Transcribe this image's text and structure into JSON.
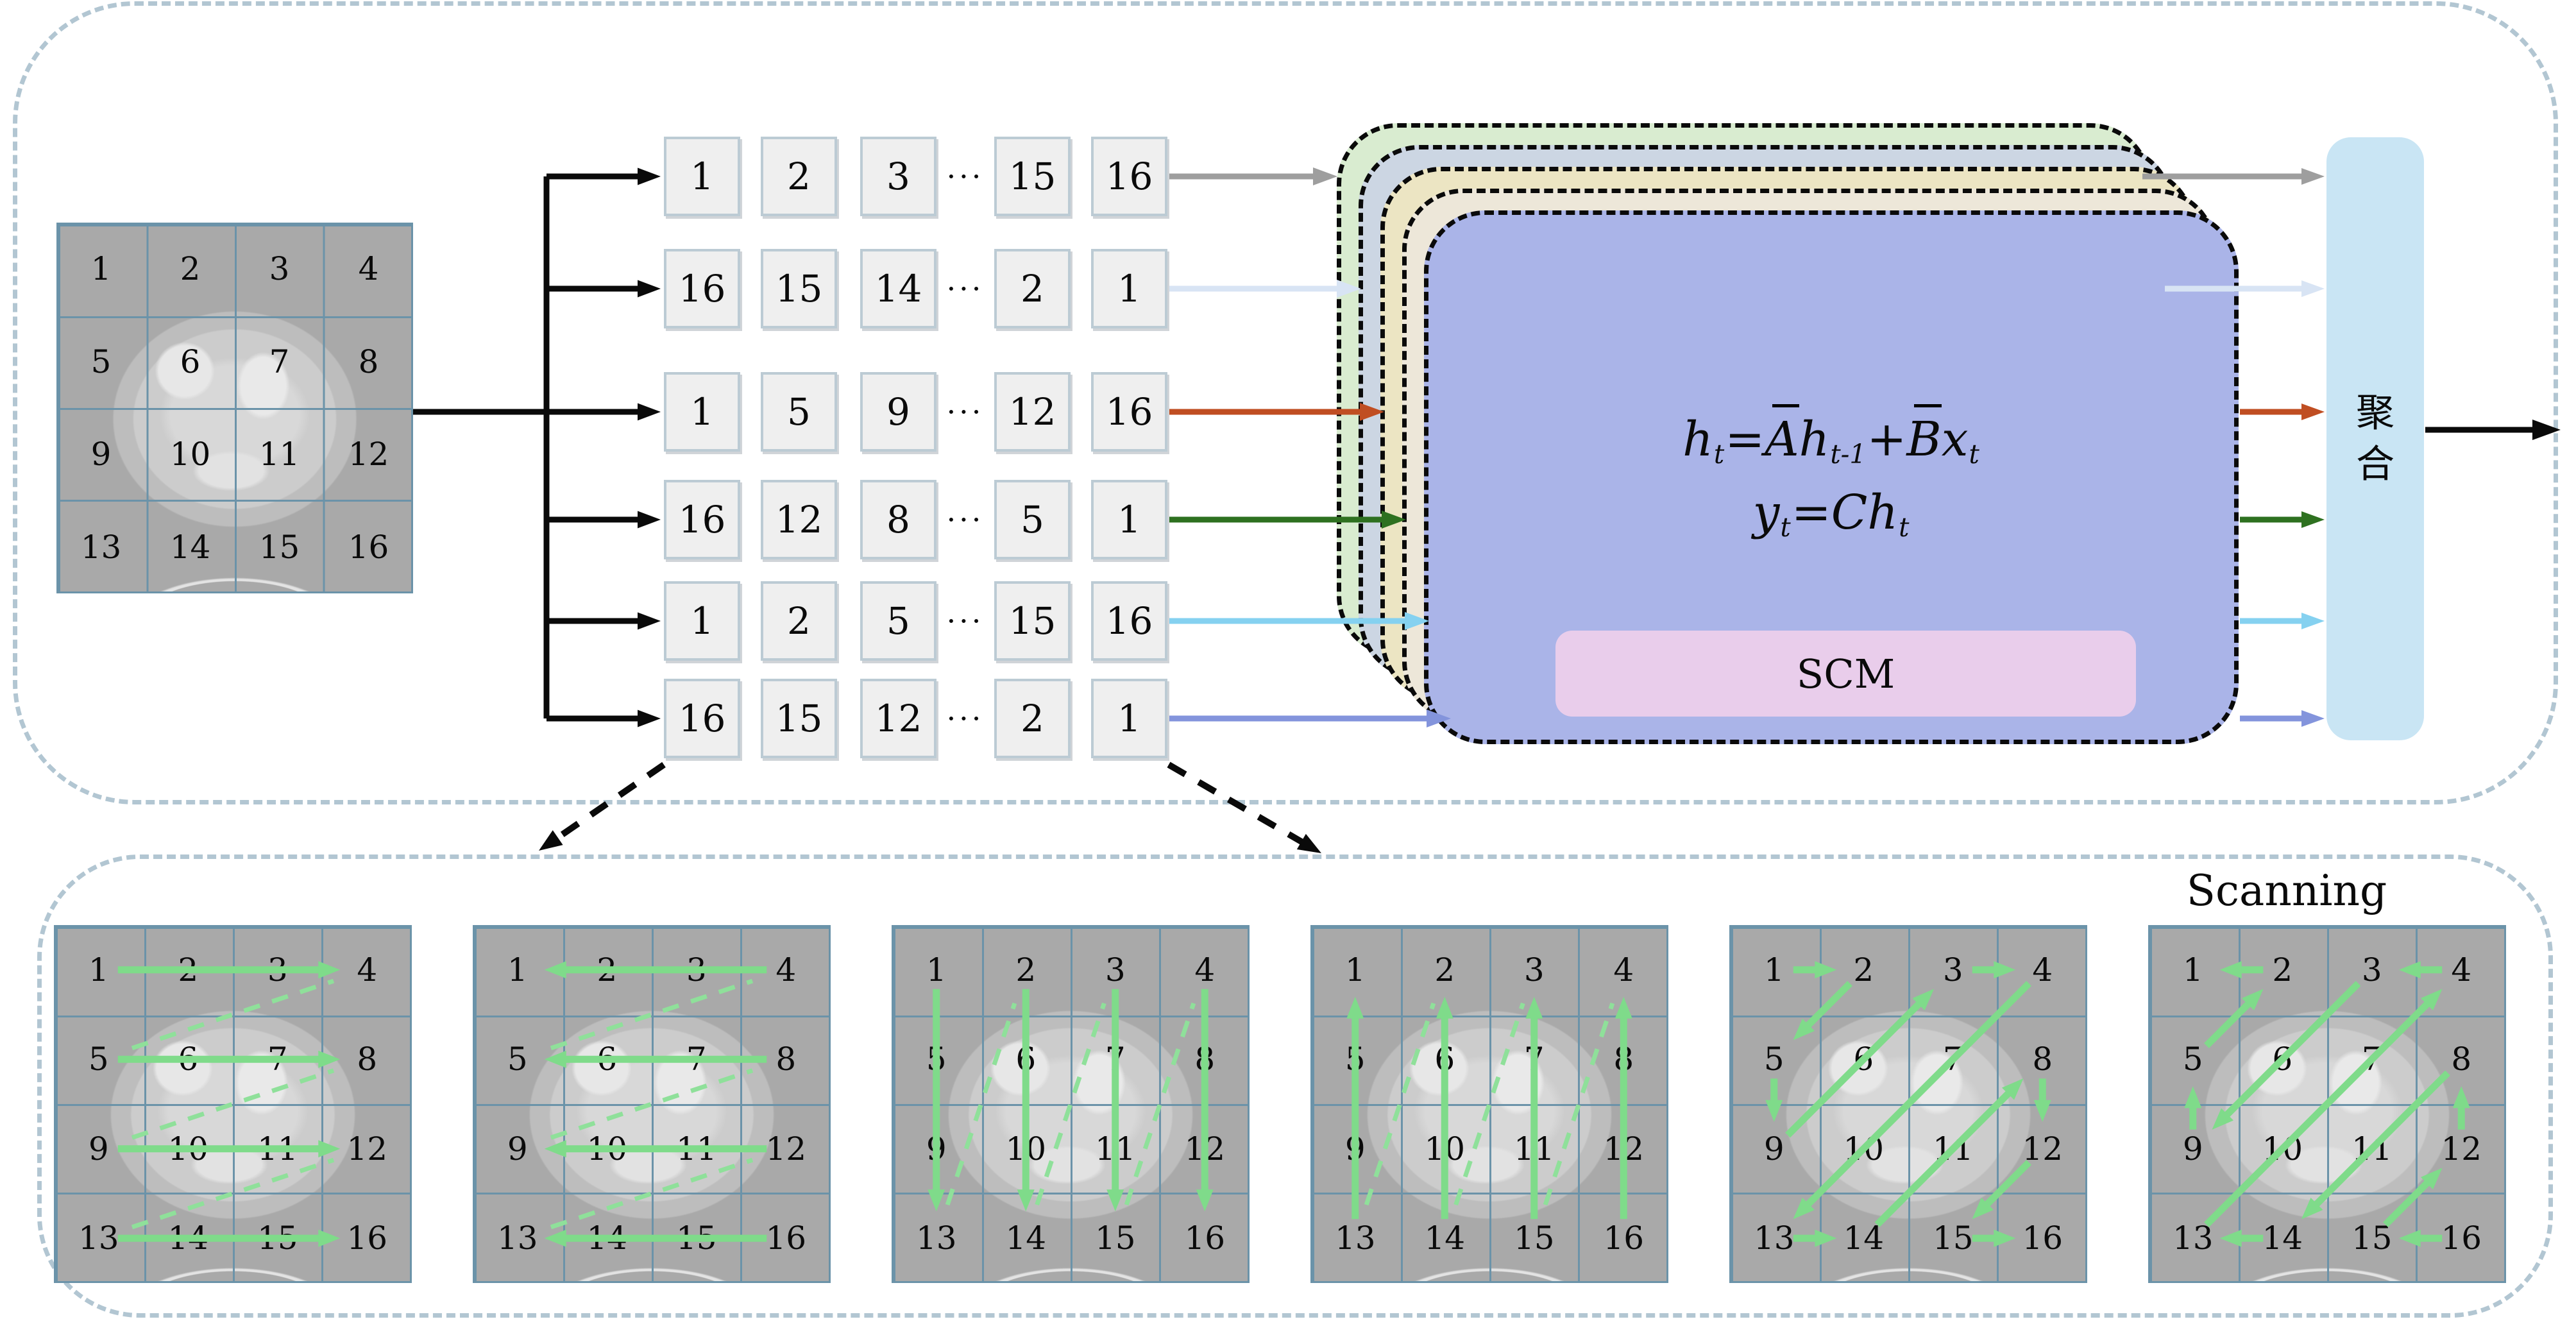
{
  "diagram": {
    "grid_labels": [
      "1",
      "2",
      "3",
      "4",
      "5",
      "6",
      "7",
      "8",
      "9",
      "10",
      "11",
      "12",
      "13",
      "14",
      "15",
      "16"
    ],
    "sequence_rows": [
      {
        "cells": [
          "1",
          "2",
          "3",
          "···",
          "15",
          "16"
        ],
        "color": "#9e9e9e"
      },
      {
        "cells": [
          "16",
          "15",
          "14",
          "···",
          "2",
          "1"
        ],
        "color": "#d8e4f4"
      },
      {
        "cells": [
          "1",
          "5",
          "9",
          "···",
          "12",
          "16"
        ],
        "color": "#c04e22"
      },
      {
        "cells": [
          "16",
          "12",
          "8",
          "···",
          "5",
          "1"
        ],
        "color": "#2e7120"
      },
      {
        "cells": [
          "1",
          "2",
          "5",
          "···",
          "15",
          "16"
        ],
        "color": "#85d1f0"
      },
      {
        "cells": [
          "16",
          "15",
          "12",
          "···",
          "2",
          "1"
        ],
        "color": "#8394dc"
      }
    ],
    "stack_layers": [
      "#d9ecd0",
      "#ccd6e3",
      "#ece5c3",
      "#ede7d9",
      "#aab4e8"
    ],
    "stack_border": "#0a0a0a",
    "equations": {
      "line1": [
        [
          "h",
          "i"
        ],
        [
          "t",
          "sub"
        ],
        [
          "=",
          "p"
        ],
        [
          "A",
          "ibar"
        ],
        [
          "h",
          "i"
        ],
        [
          "t-1",
          "sub"
        ],
        [
          "+",
          "p"
        ],
        [
          "B",
          "ibar"
        ],
        [
          "x",
          "i"
        ],
        [
          "t",
          "sub"
        ]
      ],
      "line2": [
        [
          "y",
          "i"
        ],
        [
          "t",
          "sub"
        ],
        [
          "=",
          "p"
        ],
        [
          "C",
          "i"
        ],
        [
          "h",
          "i"
        ],
        [
          "t",
          "sub"
        ]
      ]
    },
    "scm_label": "SCM",
    "aggregate_label": "聚合",
    "scanning_label": "Scanning",
    "arrow_green": "#7fdb8a",
    "arrow_green_dash": "#8fe09a",
    "panel_border_color": "#b2c6d2",
    "grid_line_color": "#6b93a9",
    "scan_patterns": [
      {
        "solid": [
          [
            [
              0,
              0
            ],
            [
              3,
              0
            ]
          ],
          [
            [
              0,
              1
            ],
            [
              3,
              1
            ]
          ],
          [
            [
              0,
              2
            ],
            [
              3,
              2
            ]
          ],
          [
            [
              0,
              3
            ],
            [
              3,
              3
            ]
          ]
        ],
        "dashed": [
          [
            [
              0,
              1
            ],
            [
              3,
              0
            ]
          ],
          [
            [
              0,
              2
            ],
            [
              3,
              1
            ]
          ],
          [
            [
              0,
              3
            ],
            [
              3,
              2
            ]
          ]
        ]
      },
      {
        "solid": [
          [
            [
              3,
              0
            ],
            [
              0,
              0
            ]
          ],
          [
            [
              3,
              1
            ],
            [
              0,
              1
            ]
          ],
          [
            [
              3,
              2
            ],
            [
              0,
              2
            ]
          ],
          [
            [
              3,
              3
            ],
            [
              0,
              3
            ]
          ]
        ],
        "dashed": [
          [
            [
              0,
              1
            ],
            [
              3,
              0
            ]
          ],
          [
            [
              0,
              2
            ],
            [
              3,
              1
            ]
          ],
          [
            [
              0,
              3
            ],
            [
              3,
              2
            ]
          ]
        ]
      },
      {
        "solid": [
          [
            [
              0,
              0
            ],
            [
              0,
              3
            ]
          ],
          [
            [
              1,
              0
            ],
            [
              1,
              3
            ]
          ],
          [
            [
              2,
              0
            ],
            [
              2,
              3
            ]
          ],
          [
            [
              3,
              0
            ],
            [
              3,
              3
            ]
          ]
        ],
        "dashed": [
          [
            [
              0,
              3
            ],
            [
              1,
              0
            ]
          ],
          [
            [
              1,
              3
            ],
            [
              2,
              0
            ]
          ],
          [
            [
              2,
              3
            ],
            [
              3,
              0
            ]
          ]
        ]
      },
      {
        "solid": [
          [
            [
              0,
              3
            ],
            [
              0,
              0
            ]
          ],
          [
            [
              1,
              3
            ],
            [
              1,
              0
            ]
          ],
          [
            [
              2,
              3
            ],
            [
              2,
              0
            ]
          ],
          [
            [
              3,
              3
            ],
            [
              3,
              0
            ]
          ]
        ],
        "dashed": [
          [
            [
              0,
              3
            ],
            [
              1,
              0
            ]
          ],
          [
            [
              1,
              3
            ],
            [
              2,
              0
            ]
          ],
          [
            [
              2,
              3
            ],
            [
              3,
              0
            ]
          ]
        ]
      },
      {
        "solid": [
          [
            [
              0,
              0
            ],
            [
              1,
              0
            ]
          ],
          [
            [
              1,
              0
            ],
            [
              0,
              1
            ]
          ],
          [
            [
              0,
              1
            ],
            [
              0,
              2
            ]
          ],
          [
            [
              0,
              2
            ],
            [
              2,
              0
            ]
          ],
          [
            [
              2,
              0
            ],
            [
              3,
              0
            ]
          ],
          [
            [
              3,
              0
            ],
            [
              0,
              3
            ]
          ],
          [
            [
              0,
              3
            ],
            [
              1,
              3
            ]
          ],
          [
            [
              1,
              3
            ],
            [
              3,
              1
            ]
          ],
          [
            [
              3,
              1
            ],
            [
              3,
              2
            ]
          ],
          [
            [
              3,
              2
            ],
            [
              2,
              3
            ]
          ],
          [
            [
              2,
              3
            ],
            [
              3,
              3
            ]
          ]
        ],
        "dashed": []
      },
      {
        "solid": [
          [
            [
              3,
              3
            ],
            [
              2,
              3
            ]
          ],
          [
            [
              2,
              3
            ],
            [
              3,
              2
            ]
          ],
          [
            [
              3,
              2
            ],
            [
              3,
              1
            ]
          ],
          [
            [
              3,
              1
            ],
            [
              1,
              3
            ]
          ],
          [
            [
              1,
              3
            ],
            [
              0,
              3
            ]
          ],
          [
            [
              0,
              3
            ],
            [
              3,
              0
            ]
          ],
          [
            [
              3,
              0
            ],
            [
              2,
              0
            ]
          ],
          [
            [
              2,
              0
            ],
            [
              0,
              2
            ]
          ],
          [
            [
              0,
              2
            ],
            [
              0,
              1
            ]
          ],
          [
            [
              0,
              1
            ],
            [
              1,
              0
            ]
          ],
          [
            [
              1,
              0
            ],
            [
              0,
              0
            ]
          ]
        ],
        "dashed": []
      }
    ]
  }
}
